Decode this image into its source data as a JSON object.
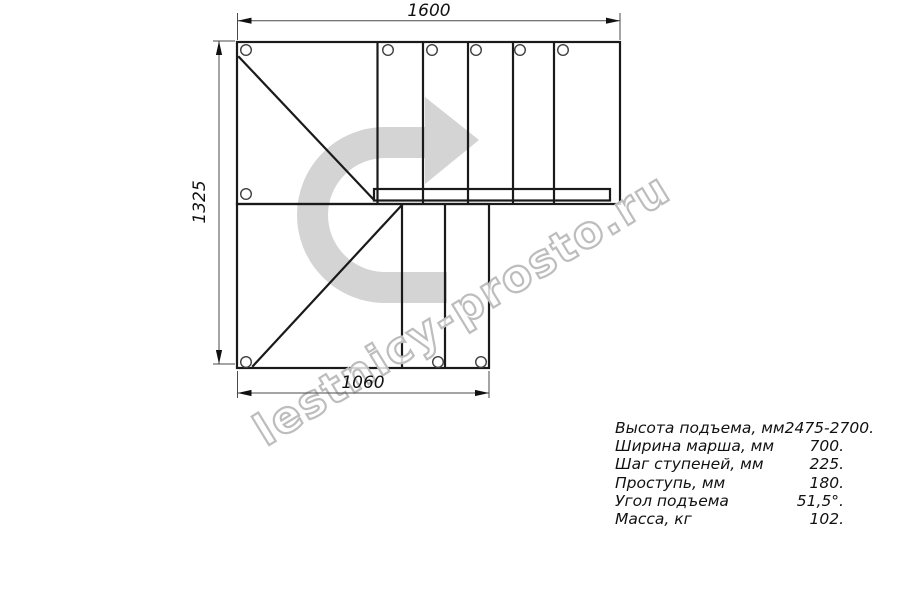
{
  "drawing": {
    "type_note": "L-shaped staircase plan view",
    "dimensions": {
      "top": "1600",
      "left": "1325",
      "bottom": "1060"
    },
    "watermark_text": "lestnicy-prosto.ru",
    "icons": {
      "turn_arrow": "u-turn-right-arrow-watermark"
    }
  },
  "specs": {
    "rows": [
      {
        "label": "Высота подъема, мм",
        "value": "2475-2700."
      },
      {
        "label": "Ширина марша, мм",
        "value": "700."
      },
      {
        "label": "Шаг ступеней, мм",
        "value": "225."
      },
      {
        "label": "Проступь, мм",
        "value": "180."
      },
      {
        "label": "Угол подъема",
        "value": "51,5°."
      },
      {
        "label": "Масса, кг",
        "value": "102."
      }
    ]
  },
  "colors": {
    "background": "#ffffff",
    "line": "#1a1a1a",
    "dimension": "#4a4a4a",
    "watermark_gray": "#d4d4d4",
    "watermark_outline": "#bdbdbd",
    "text": "#111111"
  }
}
